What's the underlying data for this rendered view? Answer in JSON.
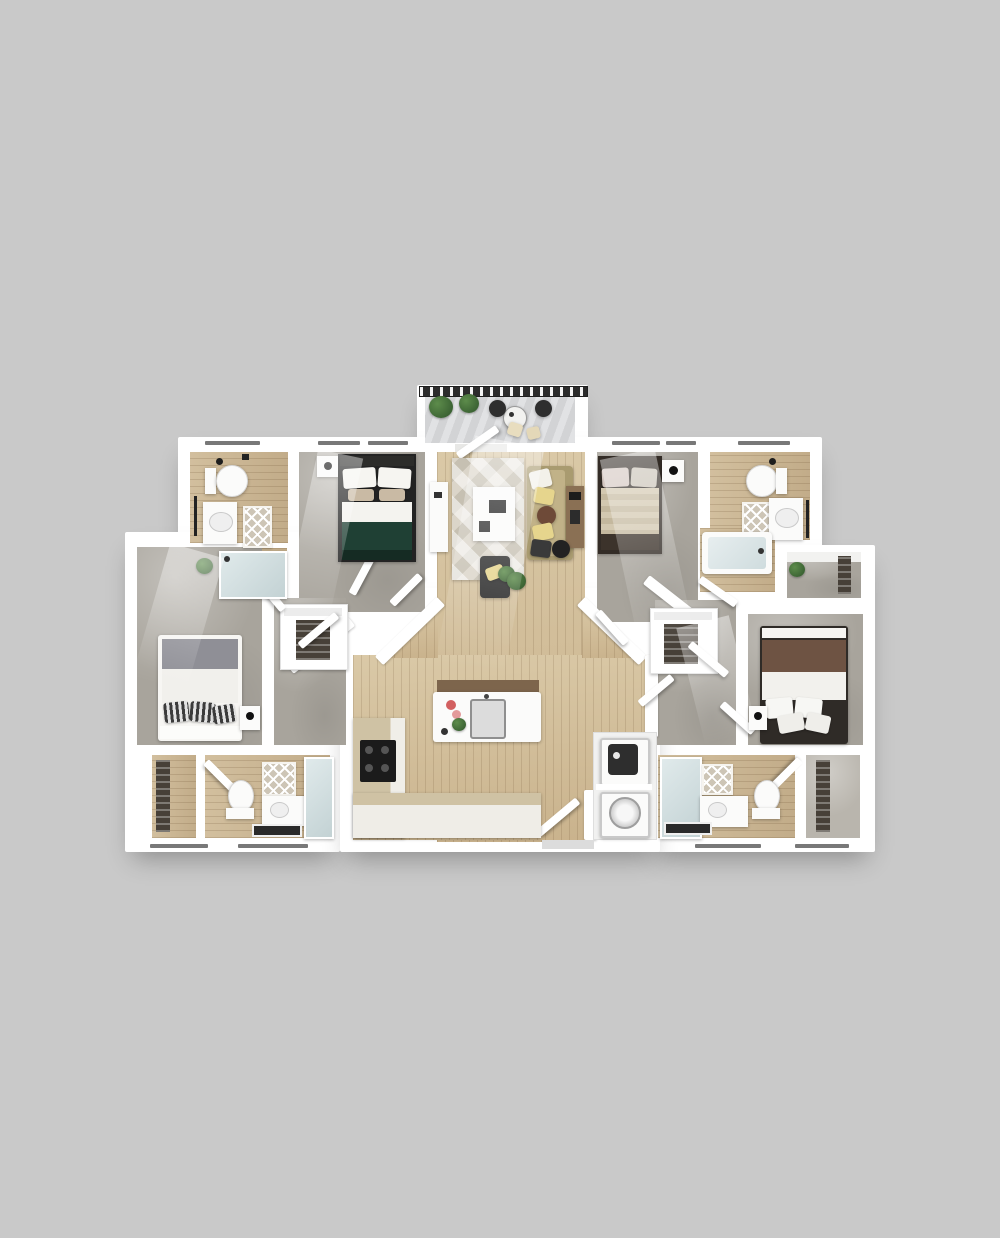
{
  "scene": {
    "kind": "3d-rendered-floor-plan",
    "description": "Top-down 3D render of a four-bedroom, four-bathroom apartment with central living room, open kitchen, laundry closet and a furnished balcony"
  },
  "rooms": [
    {
      "id": "balcony",
      "name": "Balcony"
    },
    {
      "id": "bathroom-top-left",
      "name": "Bathroom"
    },
    {
      "id": "bedroom-top-left",
      "name": "Bedroom"
    },
    {
      "id": "living-room",
      "name": "Living Room"
    },
    {
      "id": "bedroom-top-right",
      "name": "Bedroom"
    },
    {
      "id": "bathroom-top-right",
      "name": "Bathroom"
    },
    {
      "id": "bedroom-left",
      "name": "Bedroom"
    },
    {
      "id": "bedroom-right",
      "name": "Bedroom"
    },
    {
      "id": "kitchen",
      "name": "Kitchen"
    },
    {
      "id": "closet-left",
      "name": "Walk-in Closet"
    },
    {
      "id": "closet-right",
      "name": "Walk-in Closet"
    },
    {
      "id": "laundry-closet",
      "name": "Laundry Closet"
    },
    {
      "id": "bathroom-bottom-left",
      "name": "Bathroom"
    },
    {
      "id": "bathroom-bottom-right",
      "name": "Bathroom"
    },
    {
      "id": "closet-bottom-left",
      "name": "Closet"
    },
    {
      "id": "closet-bottom-right",
      "name": "Closet"
    },
    {
      "id": "shower-room-left",
      "name": "Shower"
    },
    {
      "id": "tub-nook-right",
      "name": "Bathtub"
    },
    {
      "id": "entry",
      "name": "Entry"
    },
    {
      "id": "hallway-left",
      "name": "Hallway"
    },
    {
      "id": "hallway-right",
      "name": "Hallway"
    },
    {
      "id": "closet-top-right",
      "name": "Closet"
    }
  ],
  "furniture": {
    "balcony": [
      "railing",
      "two potted plants",
      "bistro table",
      "two dark chairs",
      "two cream stools"
    ],
    "living_room": [
      "media console",
      "area rug",
      "white work table",
      "tan sofa with pillows",
      "dark armchair",
      "potted plant",
      "desk",
      "desk chair"
    ],
    "kitchen": [
      "island with sink and flowers",
      "bar counter with stools",
      "L-shaped counter",
      "cooktop",
      "base cabinets"
    ],
    "bedroom_top_left": [
      "green bed",
      "white pillows",
      "nightstand with lamp"
    ],
    "bedroom_top_right": [
      "beige bed with dark frame",
      "pillows",
      "nightstand with clock"
    ],
    "bedroom_left": [
      "white bed with gray blanket",
      "striped pillows",
      "nightstand with lamp"
    ],
    "bedroom_right": [
      "white bed with brown blanket",
      "white pillows",
      "nightstand with lamp"
    ],
    "bathrooms": [
      "toilet",
      "vanity with sink",
      "lattice bath mat",
      "towel ladder",
      "glass shower",
      "bathtub"
    ],
    "laundry_closet": [
      "stacked dryer",
      "front-load washer"
    ]
  },
  "colors": {
    "bg": "#c9c9c9",
    "wall": "#ffffff",
    "wood": "#c9b28c",
    "wood_light": "#dac9a7",
    "bath_wood": "#c2ac89",
    "bath_wood_light": "#d2bf9e",
    "carpet": "#a8a49c",
    "carpet_light": "#b9b5ad",
    "deck": "#d2d3d5",
    "deck_light": "#e1e2e4",
    "railing": "#2c2c2c",
    "green_bed": "#1f4034",
    "green_bed_dark": "#152b23",
    "gray_blanket": "#8f8f96",
    "brown_blanket": "#6e5343",
    "beige_duvet": "#cfc3ab",
    "bed_frame_dark": "#332c26",
    "sofa": "#a99b70",
    "sofa_light": "#c1b288",
    "rug": "#dbd5c9",
    "rug_accent": "#c6c0b2",
    "chair_dark": "#2b2b2b",
    "pillow_yellow": "#e6d58d",
    "counter_tan": "#cfc2a4",
    "island_bar": "#7d654c",
    "stove_black": "#1b1b1b",
    "shelf_dark": "#474038",
    "plant": "#3c6434",
    "plant_light": "#5d8c4b",
    "fixture_white": "#fbfbfa",
    "glass_blue": "#c3d2d4"
  }
}
